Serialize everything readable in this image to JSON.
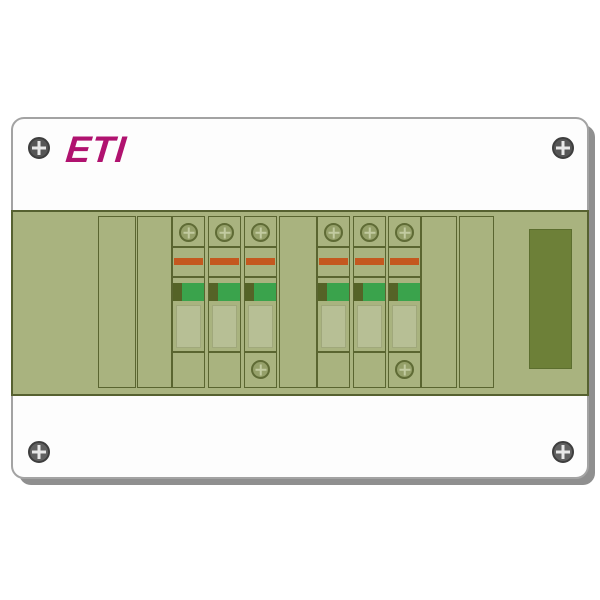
{
  "brand": {
    "logo_text": "ETI"
  },
  "colors": {
    "page-bg": "#ffffff",
    "enclosure-fill": "#fdfdfd",
    "enclosure-border": "#a3a3a3",
    "shadow": "#8f8f8f",
    "panel-fill": "#a9b37f",
    "panel-border": "#566130",
    "module-border": "#5a6530",
    "slot-fill": "#6d8038",
    "slot-border": "#5c6e2f",
    "stripe-red": "#c4581f",
    "handle-green": "#3aa34c",
    "handle-dark": "#556327",
    "label-window": "#b7bf95",
    "terminal-screw-fill": "#95a069",
    "terminal-screw-border": "#5f6b35",
    "terminal-screw-cross": "#c2caa0",
    "corner-screw-fill": "#616161",
    "corner-screw-border": "#3e3e3e",
    "corner-screw-cross": "#e8e8e8",
    "logo-magenta": "#b0126f"
  },
  "enclosure": {
    "corner_screw_count": 4
  },
  "panel": {
    "blank_module_count": 5,
    "side_slot": true,
    "fuse_groups": [
      {
        "id": 1,
        "poles": 3,
        "top_screws_per_pole": 1,
        "bottom_screws": 1
      },
      {
        "id": 2,
        "poles": 3,
        "top_screws_per_pole": 1,
        "bottom_screws": 1
      }
    ]
  }
}
